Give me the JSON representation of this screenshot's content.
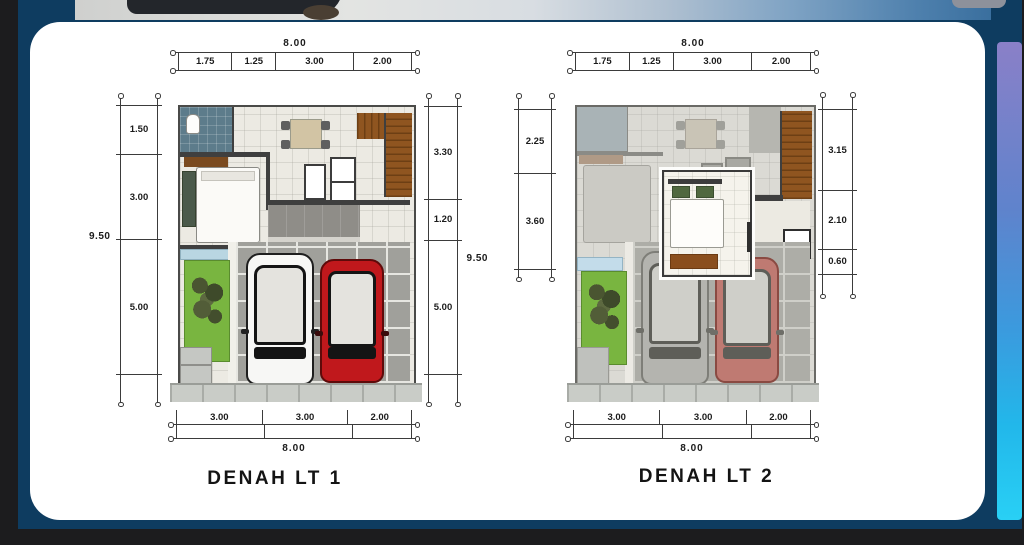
{
  "card": {
    "plans": [
      {
        "title": "DENAH LT 1",
        "dims": {
          "top": {
            "total": "8.00",
            "segments": [
              "1.75",
              "1.25",
              "3.00",
              "2.00"
            ]
          },
          "left": {
            "total": "9.50",
            "segments": [
              "1.50",
              "3.00",
              "5.00"
            ]
          },
          "right": {
            "total": "9.50",
            "segments": [
              "3.30",
              "1.20",
              "5.00"
            ]
          },
          "bottom": {
            "total": "8.00",
            "segments": [
              "3.00",
              "3.00",
              "2.00"
            ]
          }
        }
      },
      {
        "title": "DENAH LT 2",
        "dims": {
          "top": {
            "total": "8.00",
            "segments": [
              "1.75",
              "1.25",
              "3.00",
              "2.00"
            ]
          },
          "left": {
            "segments": [
              "2.25",
              "3.60"
            ]
          },
          "right": {
            "segments": [
              "3.15",
              "2.10",
              "0.60"
            ]
          },
          "bottom": {
            "total": "8.00",
            "segments": [
              "3.00",
              "3.00",
              "2.00"
            ]
          }
        }
      }
    ]
  },
  "colors": {
    "background_navy": "#0e3c60",
    "outer_black": "#1c1c1e",
    "card_white": "#ffffff",
    "dimension_line": "#3b3b3b",
    "garden_green": "#79b540",
    "stairs_brown": "#8f5520",
    "bathroom_blue_gray": "#5d7c8b",
    "car_red": "#c0181c",
    "car_white": "#f7f7f5",
    "right_strip_gradient": [
      "#8a80c8",
      "#3b9ade",
      "#29d0f5"
    ]
  }
}
